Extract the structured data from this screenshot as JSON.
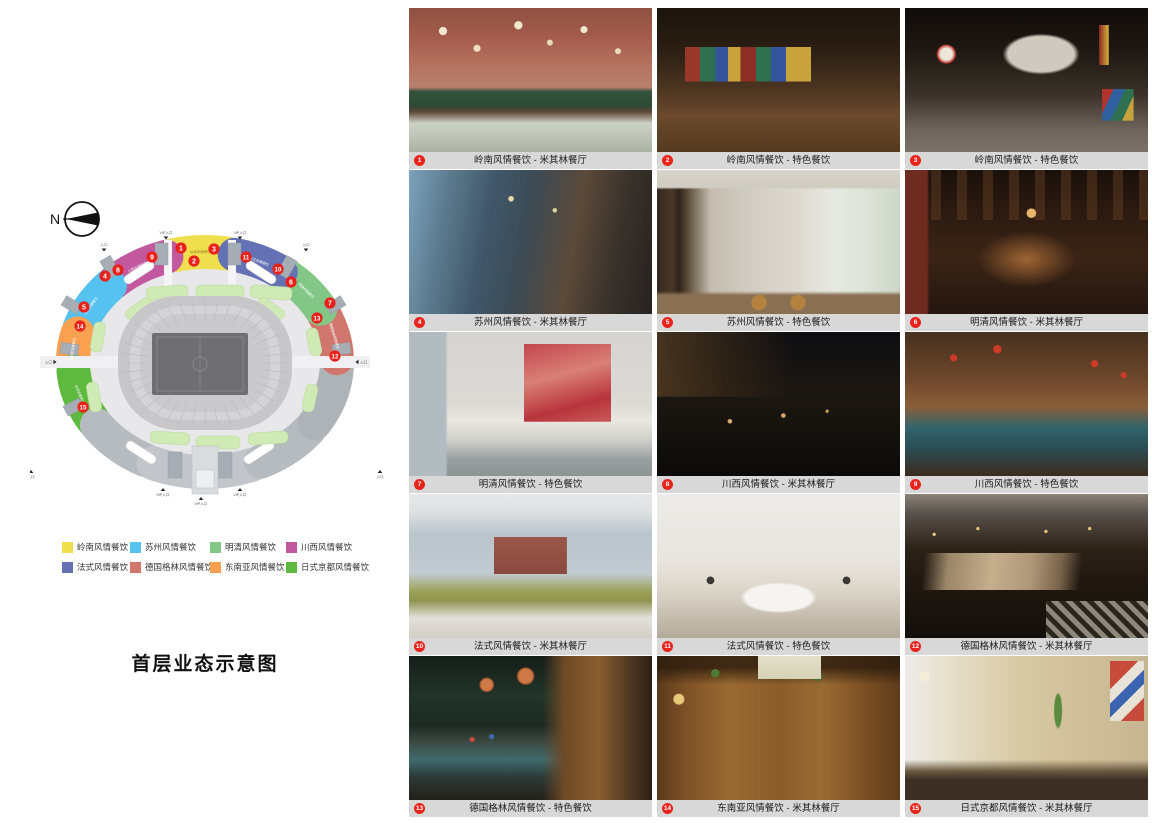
{
  "map_panel": {
    "compass_label": "N",
    "title": "首层业态示意图",
    "legend": [
      {
        "label": "岭南风情餐饮",
        "color": "#efdf4e"
      },
      {
        "label": "苏州风情餐饮",
        "color": "#55c2ef"
      },
      {
        "label": "明清风情餐饮",
        "color": "#83c787"
      },
      {
        "label": "川西风情餐饮",
        "color": "#c2589e"
      },
      {
        "label": "法式风情餐饮",
        "color": "#6472b5"
      },
      {
        "label": "德国格林风情餐饮",
        "color": "#d1766d"
      },
      {
        "label": "东南亚风情餐饮",
        "color": "#f9a150"
      },
      {
        "label": "日式京都风情餐饮",
        "color": "#5eb93f"
      }
    ],
    "sections": [
      {
        "name": "岭南风情餐饮",
        "color": "#efdf4e",
        "a1": 80,
        "a2": 104
      },
      {
        "name": "川西风情餐饮",
        "color": "#c2589e",
        "a1": 107,
        "a2": 134
      },
      {
        "name": "苏州风情餐饮",
        "color": "#55c2ef",
        "a1": 136,
        "a2": 162
      },
      {
        "name": "东南亚风情餐饮",
        "color": "#f9a150",
        "a1": 165,
        "a2": 181
      },
      {
        "name": "日式京都风情餐饮",
        "color": "#5eb93f",
        "a1": 185,
        "a2": 212
      },
      {
        "name": "",
        "color": "#b6bbc0",
        "a1": 215,
        "a2": 243
      },
      {
        "name": "",
        "color": "#c2c6ca",
        "a1": 247,
        "a2": 267
      },
      {
        "name": "",
        "color": "#c2c6ca",
        "a1": 271,
        "a2": 291
      },
      {
        "name": "",
        "color": "#b6bbc0",
        "a1": 295,
        "a2": 322
      },
      {
        "name": "",
        "color": "#aeb3b8",
        "a1": 326,
        "a2": 356
      },
      {
        "name": "德国格林风情餐饮",
        "color": "#d1766d",
        "a1": 2,
        "a2": 26
      },
      {
        "name": "明清风情餐饮",
        "color": "#83c787",
        "a1": 29,
        "a2": 52
      },
      {
        "name": "法式风情餐饮",
        "color": "#6472b5",
        "a1": 55,
        "a2": 77
      }
    ],
    "markers": [
      {
        "n": "1",
        "x": 181,
        "y": 248
      },
      {
        "n": "2",
        "x": 194,
        "y": 261
      },
      {
        "n": "3",
        "x": 214,
        "y": 249
      },
      {
        "n": "4",
        "x": 105,
        "y": 276
      },
      {
        "n": "5",
        "x": 84,
        "y": 307
      },
      {
        "n": "6",
        "x": 291,
        "y": 282
      },
      {
        "n": "7",
        "x": 330,
        "y": 303
      },
      {
        "n": "8",
        "x": 118,
        "y": 270
      },
      {
        "n": "9",
        "x": 152,
        "y": 257
      },
      {
        "n": "10",
        "x": 278,
        "y": 269
      },
      {
        "n": "11",
        "x": 246,
        "y": 257
      },
      {
        "n": "12",
        "x": 335,
        "y": 356
      },
      {
        "n": "13",
        "x": 317,
        "y": 318
      },
      {
        "n": "14",
        "x": 80,
        "y": 326
      },
      {
        "n": "15",
        "x": 83,
        "y": 407
      }
    ],
    "entrances": [
      {
        "t": "VIP入口",
        "x": 166,
        "y": 234,
        "d": "down"
      },
      {
        "t": "VIP入口",
        "x": 240,
        "y": 234,
        "d": "down"
      },
      {
        "t": "入口",
        "x": 104,
        "y": 246,
        "d": "down"
      },
      {
        "t": "入口",
        "x": 306,
        "y": 246,
        "d": "down"
      },
      {
        "t": "入口",
        "x": 52,
        "y": 362,
        "d": "right"
      },
      {
        "t": "入口",
        "x": 360,
        "y": 362,
        "d": "left"
      },
      {
        "t": "入口",
        "x": 31,
        "y": 472,
        "d": "up"
      },
      {
        "t": "入口",
        "x": 380,
        "y": 472,
        "d": "up"
      },
      {
        "t": "VIP入口",
        "x": 163,
        "y": 490,
        "d": "up"
      },
      {
        "t": "VIP入口",
        "x": 201,
        "y": 499,
        "d": "up"
      },
      {
        "t": "VIP入口",
        "x": 240,
        "y": 490,
        "d": "up"
      }
    ]
  },
  "gallery": {
    "items": [
      {
        "num": "1",
        "caption": "岭南风情餐饮 - 米其林餐厅",
        "style": "p1"
      },
      {
        "num": "2",
        "caption": "岭南风情餐饮 - 特色餐饮",
        "style": "p2"
      },
      {
        "num": "3",
        "caption": "岭南风情餐饮 - 特色餐饮",
        "style": "p3"
      },
      {
        "num": "4",
        "caption": "苏州风情餐饮 - 米其林餐厅",
        "style": "p4"
      },
      {
        "num": "5",
        "caption": "苏州风情餐饮 - 特色餐饮",
        "style": "p5"
      },
      {
        "num": "6",
        "caption": "明清风情餐饮 - 米其林餐厅",
        "style": "p6"
      },
      {
        "num": "7",
        "caption": "明清风情餐饮 - 特色餐饮",
        "style": "p7"
      },
      {
        "num": "8",
        "caption": "川西风情餐饮 - 米其林餐厅",
        "style": "p8"
      },
      {
        "num": "9",
        "caption": "川西风情餐饮 - 特色餐饮",
        "style": "p9"
      },
      {
        "num": "10",
        "caption": "法式风情餐饮 - 米其林餐厅",
        "style": "p10"
      },
      {
        "num": "11",
        "caption": "法式风情餐饮 - 特色餐饮",
        "style": "p11"
      },
      {
        "num": "12",
        "caption": "德国格林风情餐饮 - 米其林餐厅",
        "style": "p12"
      },
      {
        "num": "13",
        "caption": "德国格林风情餐饮 - 特色餐饮",
        "style": "p13"
      },
      {
        "num": "14",
        "caption": "东南亚风情餐饮 - 米其林餐厅",
        "style": "p14"
      },
      {
        "num": "15",
        "caption": "日式京都风情餐饮 - 米其林餐厅",
        "style": "p15"
      }
    ]
  }
}
